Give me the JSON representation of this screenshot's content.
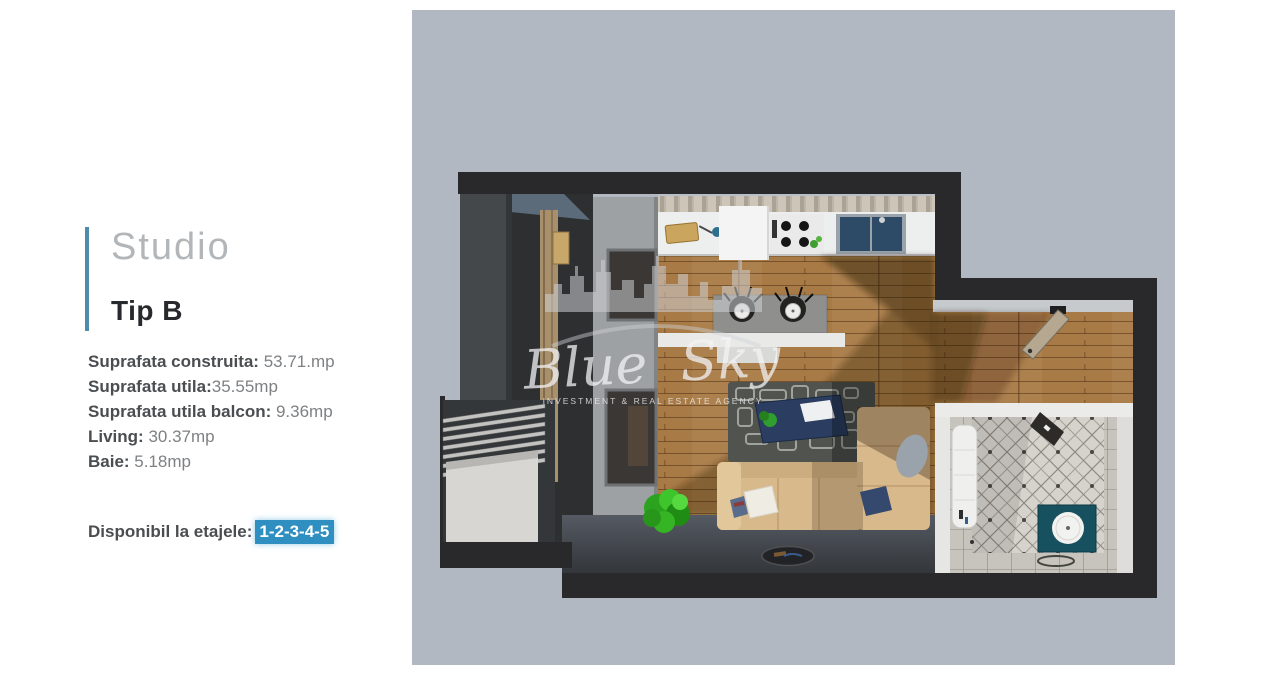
{
  "panel": {
    "title": "Studio",
    "subtitle": "Tip B",
    "details": [
      {
        "label": "Suprafata construita:",
        "value": " 53.71.mp"
      },
      {
        "label": "Suprafata utila:",
        "value": "35.55mp"
      },
      {
        "label": "Suprafata utila balcon:",
        "value": " 9.36mp"
      },
      {
        "label": "Living:",
        "value": " 30.37mp"
      },
      {
        "label": "Baie:",
        "value": " 5.18mp"
      }
    ],
    "availability": {
      "label": "Disponibil la etajele:",
      "floors": "1-2-3-4-5"
    },
    "accent_color": "#4d8cab",
    "highlight_color": "#2e8fc0"
  },
  "plan": {
    "background_color": "#b2b8c1",
    "watermark": {
      "name": "Blue Sky",
      "tagline": "INVESTMENT & REAL ESTATE AGENCY"
    }
  }
}
